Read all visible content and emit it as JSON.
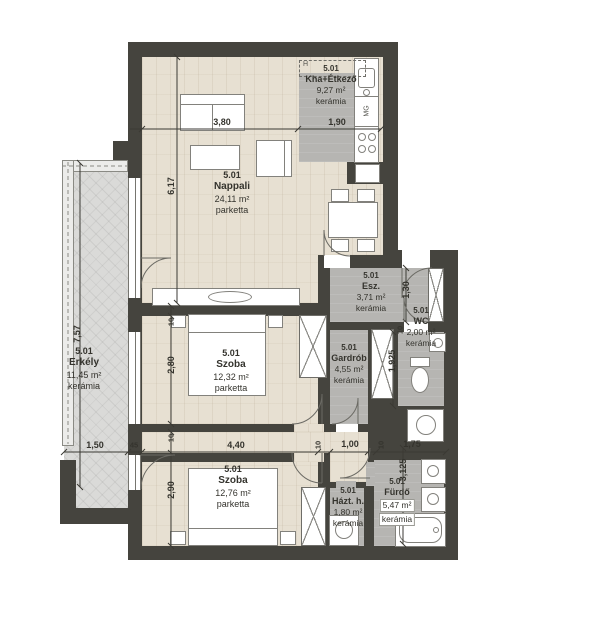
{
  "plan": {
    "rooms": {
      "nappali": {
        "unit": "5.01",
        "name": "Nappali",
        "area": "24,11 m²",
        "floor": "parketta"
      },
      "kitchen": {
        "unit": "5.01",
        "name": "Kha+Étkező",
        "area": "9,27 m²",
        "floor": "kerámia"
      },
      "erkely": {
        "unit": "5.01",
        "name": "Erkély",
        "area": "11,45 m²",
        "floor": "kerámia"
      },
      "szoba1": {
        "unit": "5.01",
        "name": "Szoba",
        "area": "12,32 m²",
        "floor": "parketta"
      },
      "szoba2": {
        "unit": "5.01",
        "name": "Szoba",
        "area": "12,76 m²",
        "floor": "parketta"
      },
      "esz": {
        "unit": "5.01",
        "name": "Esz.",
        "area": "3,71 m²",
        "floor": "kerámia"
      },
      "wc": {
        "unit": "5.01",
        "name": "WC",
        "area": "2,00 m²",
        "floor": "kerámia"
      },
      "gardrob": {
        "unit": "5.01",
        "name": "Gardrób",
        "area": "4,55 m²",
        "floor": "kerámia"
      },
      "hazt": {
        "unit": "5.01",
        "name": "Házt. h.",
        "area": "1,80 m²",
        "floor": "kerámia"
      },
      "furdo": {
        "unit": "5.01",
        "name": "Fürdő",
        "area": "5,47 m²",
        "floor": "kerámia"
      }
    },
    "dims": {
      "n_w": "3,80",
      "k_w": "1,90",
      "n_h": "6,17",
      "e_h": "7,57",
      "e_w": "1,50",
      "w45": "45",
      "t10_1": "10",
      "s1_h": "2,80",
      "t10_2": "10",
      "s2_h": "2,90",
      "s2_w": "4,40",
      "t10_3": "10",
      "c_w": "1,00",
      "t10_4": "10",
      "f_w": "1,75",
      "esz_h": "1,30",
      "t10_5": "10",
      "wc_h": "1,925",
      "f_h": "3,125"
    },
    "annotations": {
      "vent": "H",
      "dishwasher": "MG"
    }
  }
}
